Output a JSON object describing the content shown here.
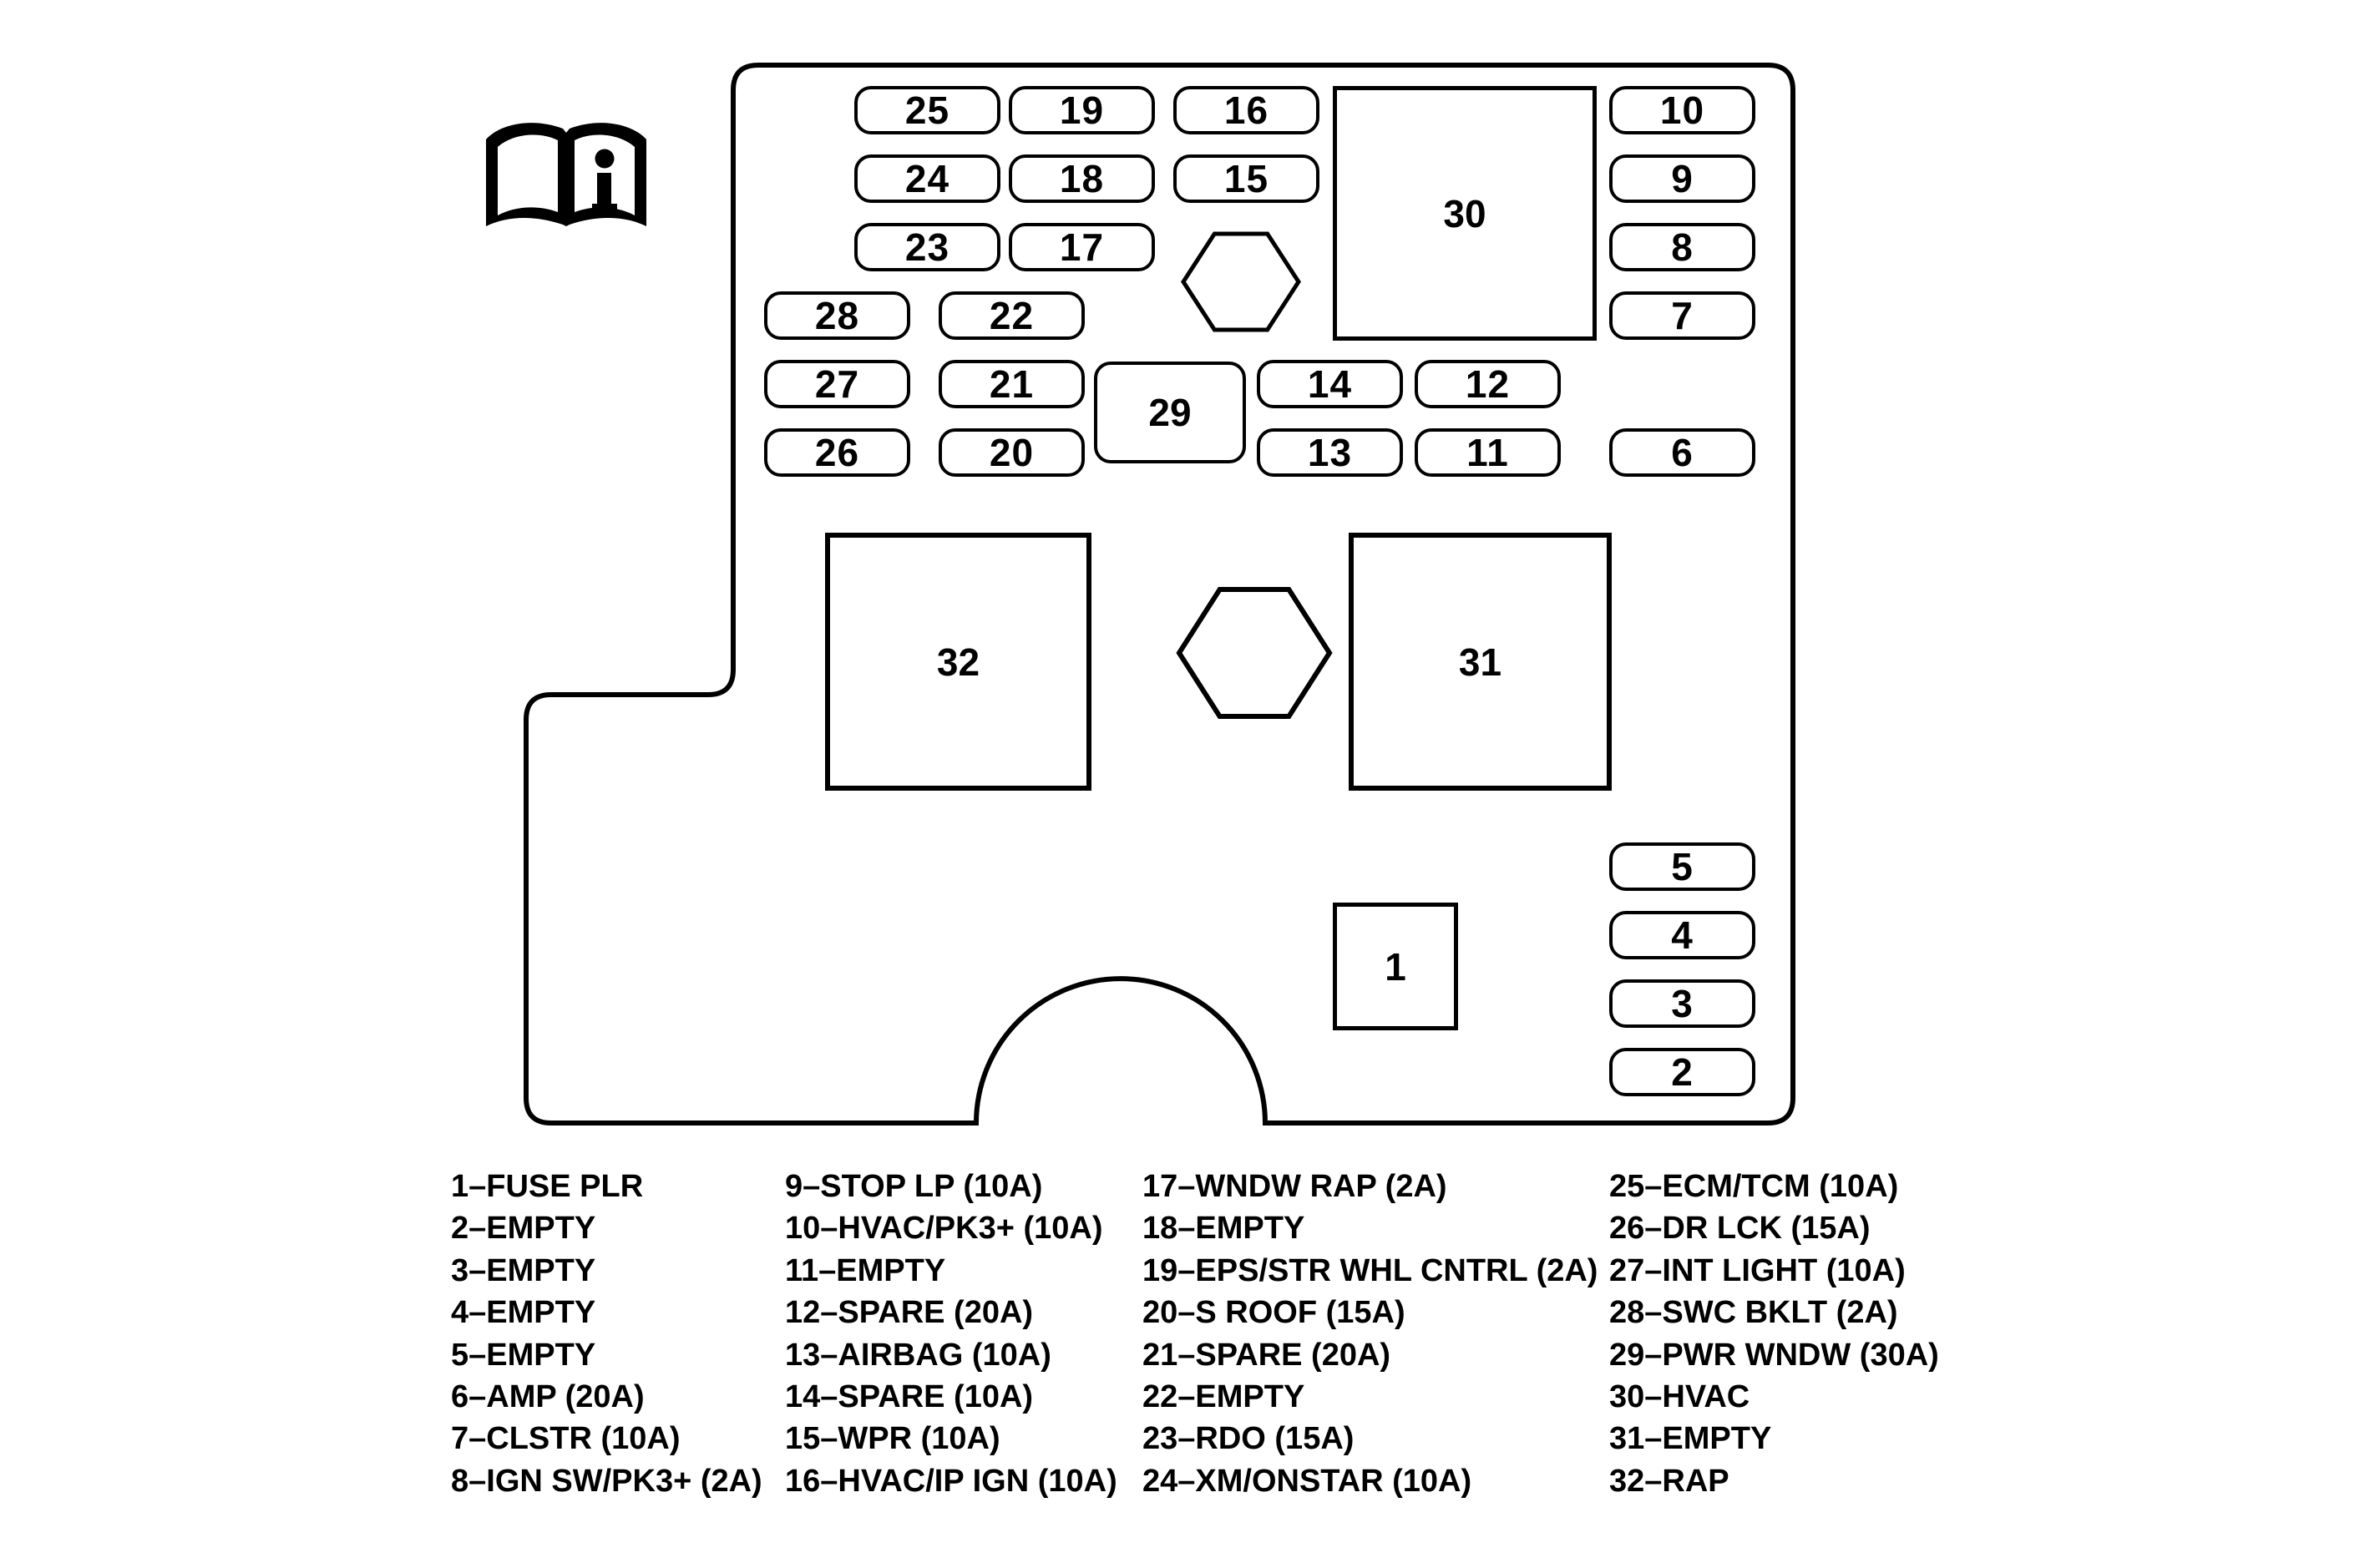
{
  "diagram": {
    "title_none": "",
    "colors": {
      "line": "#000000",
      "background": "#ffffff"
    },
    "book_icon_label": "owner-manual-info-book",
    "panel": {
      "fuses": [
        "25",
        "19",
        "16",
        "10",
        "24",
        "18",
        "15",
        "9",
        "23",
        "17",
        "8",
        "28",
        "22",
        "7",
        "27",
        "21",
        "14",
        "12",
        "26",
        "20",
        "13",
        "11",
        "6",
        "5",
        "4",
        "3",
        "2"
      ],
      "relays": [
        "30",
        "29",
        "32",
        "31",
        "1"
      ],
      "bolt_count": 2
    },
    "legend": {
      "columns": [
        {
          "items": [
            "1–FUSE PLR",
            "2–EMPTY",
            "3–EMPTY",
            "4–EMPTY",
            "5–EMPTY",
            "6–AMP (20A)",
            "7–CLSTR (10A)",
            "8–IGN SW/PK3+ (2A)"
          ]
        },
        {
          "items": [
            "9–STOP LP (10A)",
            "10–HVAC/PK3+ (10A)",
            "11–EMPTY",
            "12–SPARE (20A)",
            "13–AIRBAG (10A)",
            "14–SPARE (10A)",
            "15–WPR (10A)",
            "16–HVAC/IP IGN (10A)"
          ]
        },
        {
          "items": [
            "17–WNDW RAP (2A)",
            "18–EMPTY",
            "19–EPS/STR WHL CNTRL (2A)",
            "20–S ROOF (15A)",
            "21–SPARE (20A)",
            "22–EMPTY",
            "23–RDO (15A)",
            "24–XM/ONSTAR (10A)"
          ]
        },
        {
          "items": [
            "25–ECM/TCM (10A)",
            "26–DR LCK (15A)",
            "27–INT LIGHT (10A)",
            "28–SWC BKLT (2A)",
            "29–PWR WNDW (30A)",
            "30–HVAC",
            "31–EMPTY",
            "32–RAP"
          ]
        }
      ]
    }
  }
}
